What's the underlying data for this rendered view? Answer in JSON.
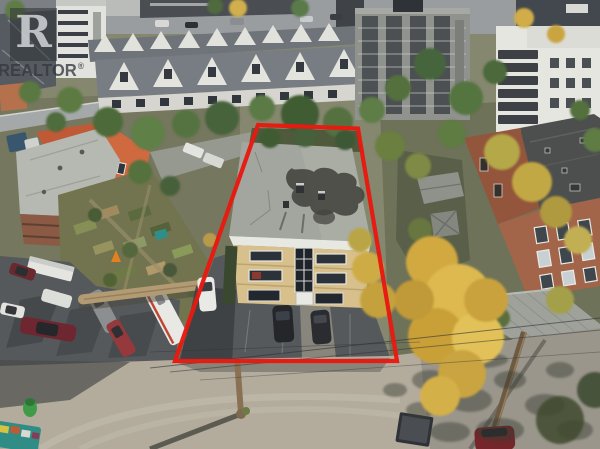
{
  "image": {
    "description": "Aerial drone photo of a three-storey tan-brick apartment building and its front parking lot outlined in red, surrounded by grey-roofed townhouses, mid-rise apartment towers, a community garden, a car-filled parking lot, a red-brick low-rise and golden autumn trees, with a gravel lane across the bottom",
    "width_px": 600,
    "height_px": 449
  },
  "watermark": {
    "logo_letter": "R",
    "brand": "REALTOR",
    "registered_mark": "®"
  },
  "colors": {
    "boundary-red": "#e8190f",
    "watermark-box-bg": "rgba(45,49,53,0.55)",
    "watermark-letter": "rgba(224,227,229,0.78)",
    "watermark-text": "rgba(52,57,60,0.78)"
  }
}
